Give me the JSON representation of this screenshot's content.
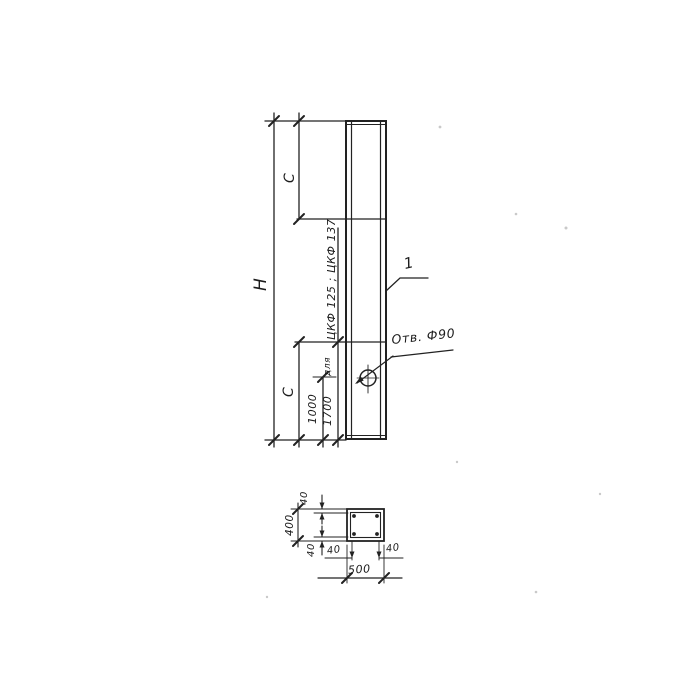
{
  "drawing": {
    "elevation": {
      "height_label": "H",
      "c_top_label": "C",
      "c_bottom_label": "C",
      "dim_1000": "1000",
      "dim_1700": "1700",
      "note_small": "для",
      "note_types": "ЦКФ 125 ; ЦКФ 137",
      "part_callout": "1",
      "hole_label": "Отв. Ф90"
    },
    "section": {
      "cover_top": "40",
      "height": "400",
      "cover_bottom": "40",
      "cover_left": "40",
      "cover_right": "40",
      "width": "500"
    },
    "line_color": "#222222",
    "paper_color": "#ffffff"
  }
}
